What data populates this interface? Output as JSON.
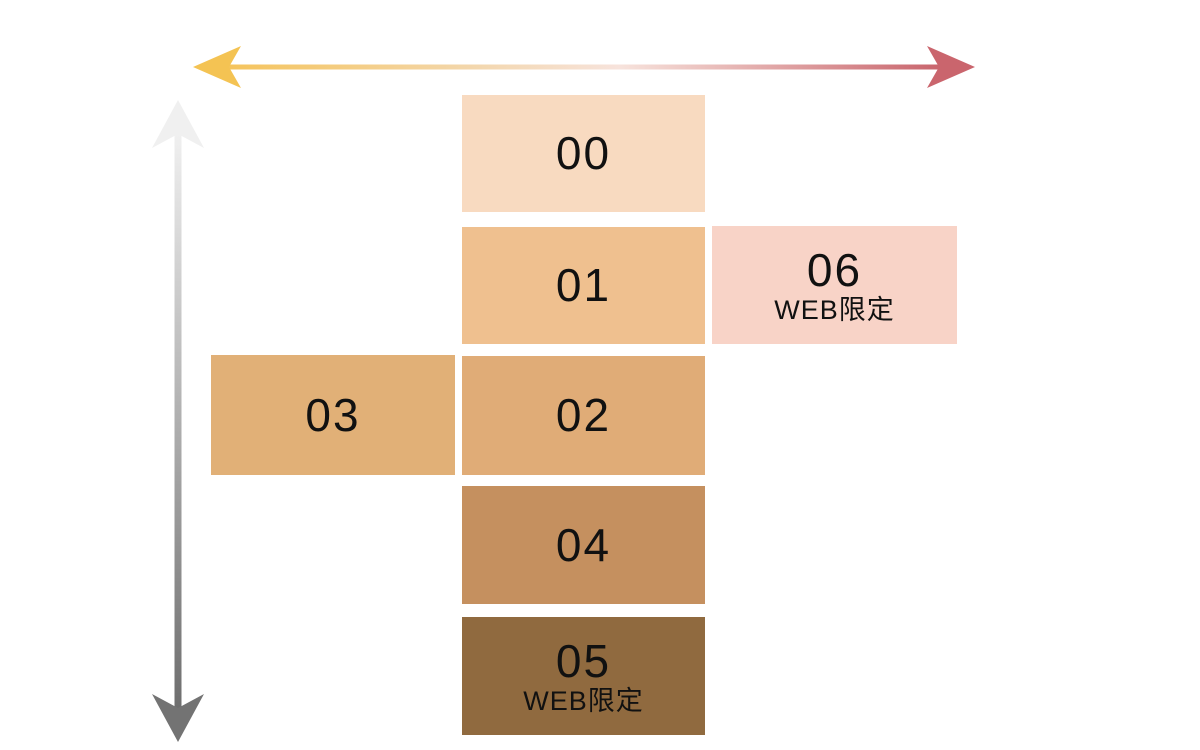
{
  "diagram": {
    "name": "shade-map",
    "label_color": "#111111",
    "horizontal_axis": {
      "style": "double-headed-gradient-arrow",
      "head_left_color": "#F4C353",
      "head_right_color": "#CA656D",
      "gradient_stops": [
        "#F5C45C",
        "#F3D7AE",
        "#F7E3DC",
        "#C9656D"
      ]
    },
    "vertical_axis": {
      "style": "double-headed-gradient-arrow",
      "head_top_color": "#F0F0F0",
      "head_bottom_color": "#737373",
      "gradient_stops": [
        "#F0F0F0",
        "#6E6E6E"
      ]
    },
    "swatches": [
      {
        "code": "00",
        "note": "",
        "color": "#F8DAC0"
      },
      {
        "code": "01",
        "note": "",
        "color": "#EFC08F"
      },
      {
        "code": "06",
        "note": "WEB限定",
        "color": "#F8D3C7"
      },
      {
        "code": "03",
        "note": "",
        "color": "#E1B077"
      },
      {
        "code": "02",
        "note": "",
        "color": "#E0AC77"
      },
      {
        "code": "04",
        "note": "",
        "color": "#C5905F"
      },
      {
        "code": "05",
        "note": "WEB限定",
        "color": "#906A3F"
      }
    ]
  }
}
